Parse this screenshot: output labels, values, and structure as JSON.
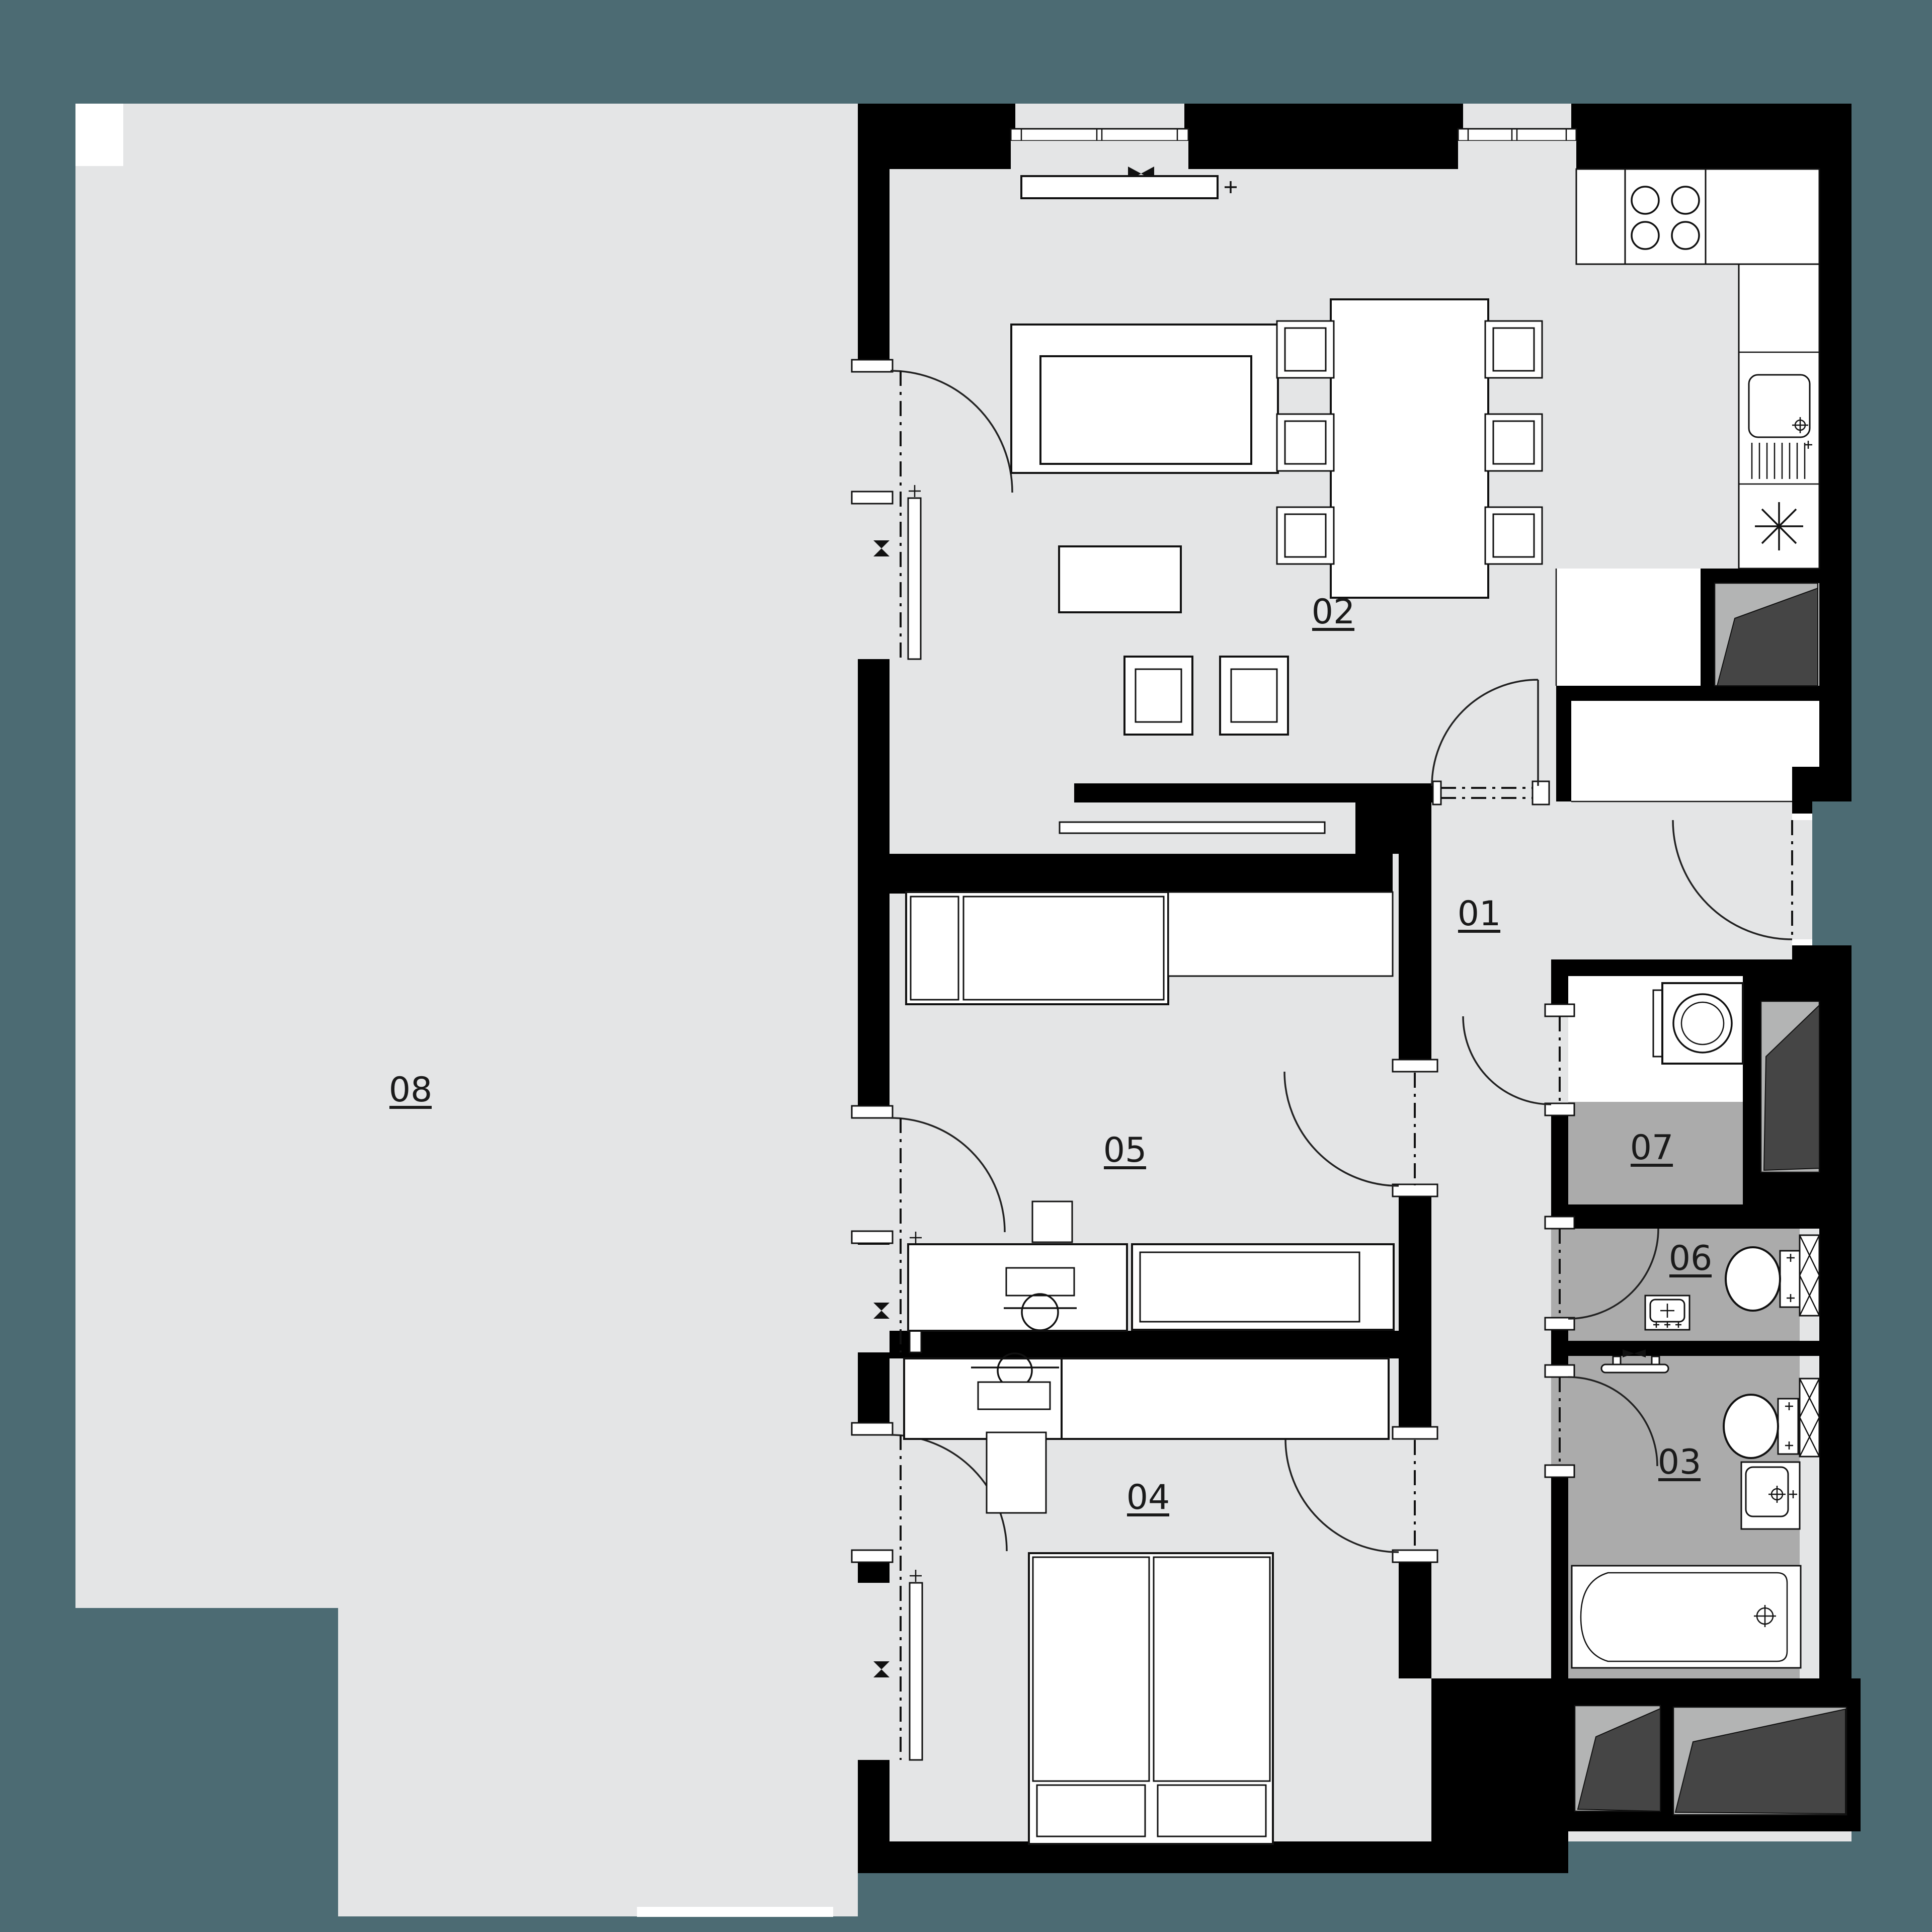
{
  "plan": {
    "title": "apartment-floor-plan",
    "colors": {
      "background": "#4C6B73",
      "floor": "#E4E5E6",
      "wet_floor": "#ABABAB",
      "shaft_background": "#B3B4B4",
      "shaft_dark": "#454545",
      "wall": "#000000",
      "fixture_white": "#FFFFFF"
    },
    "rooms": [
      {
        "id": "01",
        "label": "01"
      },
      {
        "id": "02",
        "label": "02"
      },
      {
        "id": "03",
        "label": "03"
      },
      {
        "id": "04",
        "label": "04"
      },
      {
        "id": "05",
        "label": "05"
      },
      {
        "id": "06",
        "label": "06"
      },
      {
        "id": "07",
        "label": "07"
      },
      {
        "id": "08",
        "label": "08"
      }
    ],
    "symbols": {
      "vent": "bowtie-icon",
      "appliance": "star-icon",
      "tap": "cross-plus-icon"
    }
  }
}
